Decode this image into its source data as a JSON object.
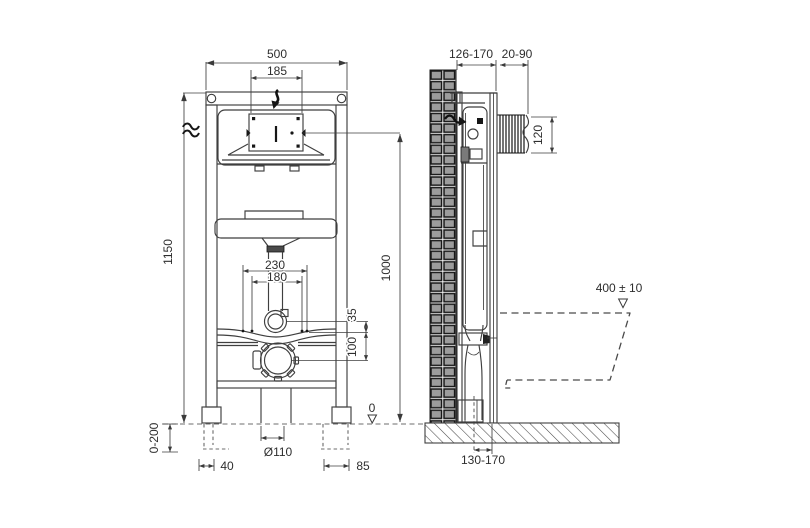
{
  "colors": {
    "line": "#3f3f3f",
    "dark": "#161616",
    "wall_fill": "#9c9c9c",
    "background": "#ffffff"
  },
  "front_view": {
    "dims": {
      "frame_width": "500",
      "panel_width": "185",
      "frame_height": "1150",
      "fixing_bolts_outer": "230",
      "fixing_bolts_inner": "180",
      "flush_elbow_offset": "35",
      "outlet_offset": "100",
      "leg_adjustment": "0-200",
      "left_foot_width": "40",
      "outlet_diameter": "Ø110",
      "right_foot_width": "85",
      "floor_datum": "0"
    }
  },
  "side_view": {
    "dims": {
      "installation_depth": "126-170",
      "finishing_depth": "20-90",
      "panel_opening_height": "120",
      "panel_center_height": "1000",
      "bowl_top_height": "400 ± 10",
      "outlet_wall_distance": "130-170"
    }
  }
}
